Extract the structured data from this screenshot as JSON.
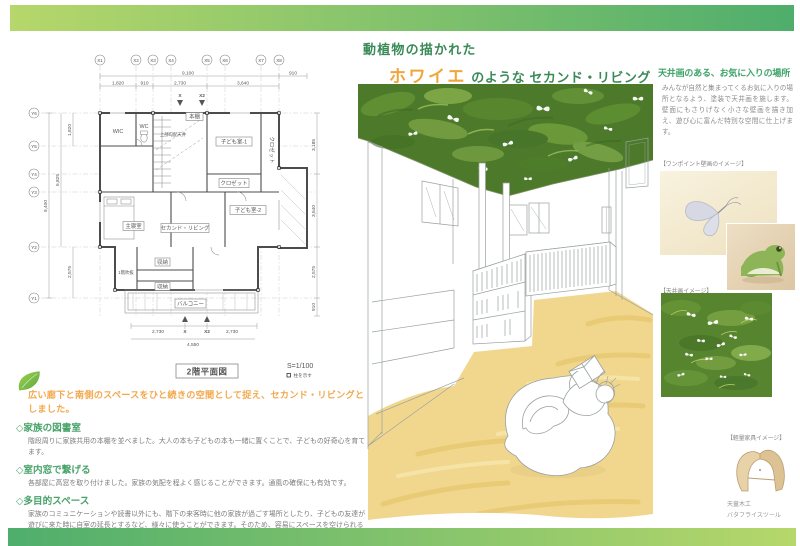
{
  "page": {
    "accent_green_light": "#b6d76b",
    "accent_green_dark": "#4fae6c",
    "background": "#ffffff"
  },
  "title": {
    "line1": "動植物の描かれた",
    "highlight": "ホワイエ",
    "line2_rest": "のような セカンド・リビング",
    "green": "#3a8a58",
    "orange": "#f0a63c"
  },
  "floor_plan": {
    "name": "2階平面図",
    "scale": "S=1/100",
    "legend": "柱を示す",
    "grid_x": [
      "X1",
      "X2",
      "X3",
      "X4",
      "X5",
      "X6",
      "X7",
      "X8"
    ],
    "grid_y": [
      "Y6",
      "Y5",
      "Y4",
      "Y3",
      "Y2",
      "Y1"
    ],
    "section_mark_x": "X",
    "section_mark_x2": "X2",
    "dims": {
      "top_total": "9,100",
      "top_right": "910",
      "top_segments": [
        "1,820",
        "910",
        "2,730",
        "3,640"
      ],
      "left": [
        "1,820",
        "6,825",
        "9,400",
        "2,575"
      ],
      "right": [
        "3,185",
        "3,640",
        "2,575",
        "910"
      ],
      "bottom_segments": [
        "2,730",
        "2,730"
      ],
      "bottom_total": "4,550"
    },
    "rooms": {
      "wic": "WIC",
      "wc": "WC",
      "sloped_ceiling": "上部勾配天井",
      "bookshelf": "本棚",
      "kids1": "子ども室-1",
      "closet1": "クロゼット",
      "closet2": "クロゼット",
      "kids2": "子ども室-2",
      "master": "主寝室",
      "second_living": "セカンド・リビング",
      "storage1": "収納",
      "void_below": "1階吹抜",
      "storage2": "収納",
      "balcony": "バルコニー"
    }
  },
  "right_column": {
    "heading": "天井画のある、お気に入りの場所",
    "heading_color": "#3fa368",
    "body": "みんなが自然と集まってくるお気に入りの場所となるよう、塗装で天井画を施します。壁面にもさりげなく小さな壁画を描き加え、遊び心に富んだ特別な空間に仕上げます。",
    "caption_wall_art": "【ワンポイント壁画のイメージ】",
    "caption_ceiling_art": "【天井画イメージ】",
    "caption_furniture": "【軽量家具イメージ】",
    "furniture_maker": "天童木工",
    "furniture_name": "バタフライスツール"
  },
  "features": {
    "lead": "広い廊下と南側のスペースをひと続きの空間として捉え、セカンド・リビングとしました。",
    "lead_color": "#f2a94e",
    "heading_color": "#4aa36b",
    "items": [
      {
        "heading": "◇家族の図書室",
        "body": "階段周りに家族共用の本棚を並べました。大人の本も子どもの本も一緒に置くことで、子どもの好奇心を育てます。"
      },
      {
        "heading": "◇室内窓で繋げる",
        "body": "各部屋に高窓を取り付けました。家族の気配を程よく感じることができます。通風の確保にも有効です。"
      },
      {
        "heading": "◇多目的スペース",
        "body": "家族のコミュニケーションや読書以外にも、階下の来客時に他の家族が過ごす場所としたり、子どもの友達が遊びに来た時に自室の延長とするなど、様々に使うことができます。そのため、容易にスペースを空けられるよう、家具は軽量で小ぶりなものを選択します。\nまた、可動間仕切りを引けば南側のスペースが独立し、ゲストの宿泊にも対応できます。部屋干しスペースにも適します。"
      }
    ]
  },
  "illustration": {
    "ceiling_green": "#4d7a2a",
    "floor_tan": "#f1d78e"
  }
}
